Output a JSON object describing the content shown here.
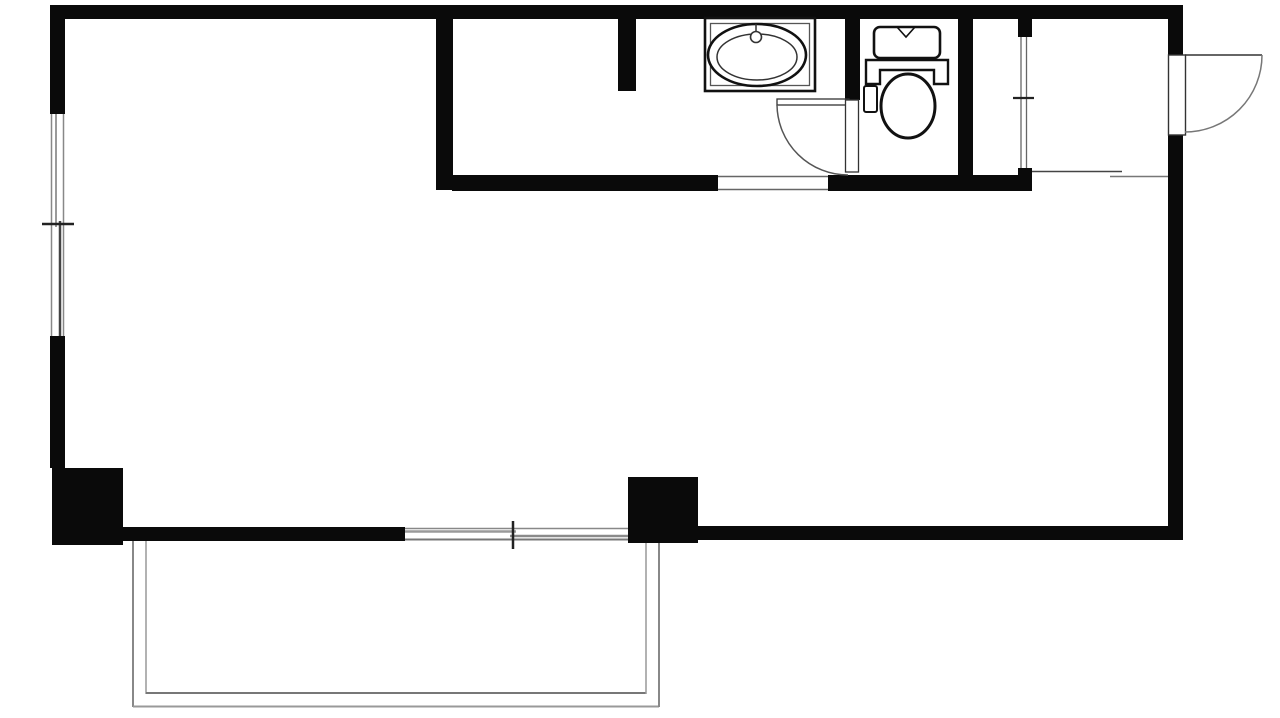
{
  "meta": {
    "title": "apartment-floor-plan",
    "canvas": {
      "width": 1280,
      "height": 718
    },
    "colors": {
      "wall": "#0a0a0a",
      "fixture_stroke": "#111111",
      "thin_dark": "#333333",
      "thin_mid": "#666666",
      "thin_light": "#999999",
      "background": "#ffffff"
    }
  },
  "plan": {
    "elements": [
      {
        "name": "top-wall",
        "kind": "rect",
        "x": 55,
        "y": 5,
        "w": 1128,
        "h": 14,
        "fill": "#0a0a0a"
      },
      {
        "name": "left-wall-upper",
        "kind": "rect",
        "x": 50,
        "y": 5,
        "w": 15,
        "h": 109,
        "fill": "#0a0a0a"
      },
      {
        "name": "left-wall-lower",
        "kind": "rect",
        "x": 50,
        "y": 336,
        "w": 15,
        "h": 132,
        "fill": "#0a0a0a"
      },
      {
        "name": "left-pillar",
        "kind": "rect",
        "x": 52,
        "y": 468,
        "w": 71,
        "h": 77,
        "fill": "#0a0a0a"
      },
      {
        "name": "bottom-wall-left",
        "kind": "rect",
        "x": 123,
        "y": 527,
        "w": 282,
        "h": 14,
        "fill": "#0a0a0a"
      },
      {
        "name": "right-pillar",
        "kind": "rect",
        "x": 628,
        "y": 477,
        "w": 70,
        "h": 66,
        "fill": "#0a0a0a"
      },
      {
        "name": "bottom-wall-right",
        "kind": "rect",
        "x": 698,
        "y": 526,
        "w": 485,
        "h": 14,
        "fill": "#0a0a0a"
      },
      {
        "name": "right-wall-upper",
        "kind": "rect",
        "x": 1168,
        "y": 5,
        "w": 15,
        "h": 50,
        "fill": "#0a0a0a"
      },
      {
        "name": "right-wall-lower",
        "kind": "rect",
        "x": 1168,
        "y": 135,
        "w": 15,
        "h": 405,
        "fill": "#0a0a0a"
      },
      {
        "name": "interior-wall-vertical",
        "kind": "rect",
        "x": 436,
        "y": 19,
        "w": 17,
        "h": 171,
        "fill": "#0a0a0a"
      },
      {
        "name": "interior-wall-horizontal-left",
        "kind": "rect",
        "x": 452,
        "y": 175,
        "w": 266,
        "h": 16,
        "fill": "#0a0a0a"
      },
      {
        "name": "interior-wall-horizontal-right",
        "kind": "rect",
        "x": 828,
        "y": 175,
        "w": 204,
        "h": 16,
        "fill": "#0a0a0a"
      },
      {
        "name": "kitchen-stub-wall",
        "kind": "rect",
        "x": 618,
        "y": 19,
        "w": 18,
        "h": 72,
        "fill": "#0a0a0a"
      },
      {
        "name": "toilet-left-wall",
        "kind": "rect",
        "x": 845,
        "y": 19,
        "w": 15,
        "h": 81,
        "fill": "#0a0a0a"
      },
      {
        "name": "toilet-right-wall",
        "kind": "rect",
        "x": 958,
        "y": 19,
        "w": 15,
        "h": 172,
        "fill": "#0a0a0a"
      },
      {
        "name": "closet-stub-top",
        "kind": "rect",
        "x": 1018,
        "y": 19,
        "w": 14,
        "h": 18,
        "fill": "#0a0a0a"
      },
      {
        "name": "closet-stub-bottom",
        "kind": "rect",
        "x": 1018,
        "y": 168,
        "w": 14,
        "h": 23,
        "fill": "#0a0a0a"
      },
      {
        "name": "left-window-bg",
        "kind": "rect",
        "x": 50,
        "y": 114,
        "w": 15,
        "h": 222,
        "fill": "#ffffff"
      },
      {
        "name": "left-window-edge-outer",
        "kind": "line",
        "x1": 51.5,
        "y1": 114,
        "x2": 51.5,
        "y2": 336,
        "stroke": "#888888",
        "sw": 1.5
      },
      {
        "name": "left-window-edge-inner",
        "kind": "line",
        "x1": 63.5,
        "y1": 114,
        "x2": 63.5,
        "y2": 336,
        "stroke": "#888888",
        "sw": 1.5
      },
      {
        "name": "left-window-sash-upper",
        "kind": "line",
        "x1": 56,
        "y1": 114,
        "x2": 56,
        "y2": 227,
        "stroke": "#9a9a9a",
        "sw": 2
      },
      {
        "name": "left-window-sash-lower",
        "kind": "line",
        "x1": 60,
        "y1": 221,
        "x2": 60,
        "y2": 336,
        "stroke": "#444444",
        "sw": 2.5
      },
      {
        "name": "left-window-tick",
        "kind": "line",
        "x1": 42,
        "y1": 224,
        "x2": 74,
        "y2": 224,
        "stroke": "#222222",
        "sw": 2.5
      },
      {
        "name": "bottom-window-bg",
        "kind": "rect",
        "x": 405,
        "y": 527,
        "w": 223,
        "h": 14,
        "fill": "#ffffff"
      },
      {
        "name": "bottom-window-edge-top",
        "kind": "line",
        "x1": 405,
        "y1": 528.5,
        "x2": 628,
        "y2": 528.5,
        "stroke": "#888888",
        "sw": 1.5
      },
      {
        "name": "bottom-window-edge-bottom",
        "kind": "line",
        "x1": 405,
        "y1": 539.5,
        "x2": 628,
        "y2": 539.5,
        "stroke": "#777777",
        "sw": 2
      },
      {
        "name": "bottom-window-sash-left",
        "kind": "line",
        "x1": 405,
        "y1": 531.5,
        "x2": 516,
        "y2": 531.5,
        "stroke": "#9a9a9a",
        "sw": 2.5
      },
      {
        "name": "bottom-window-sash-right",
        "kind": "line",
        "x1": 510,
        "y1": 536,
        "x2": 628,
        "y2": 536,
        "stroke": "#8a8a8a",
        "sw": 2.5
      },
      {
        "name": "bottom-window-tick",
        "kind": "line",
        "x1": 513,
        "y1": 521,
        "x2": 513,
        "y2": 549,
        "stroke": "#222222",
        "sw": 2.5
      },
      {
        "name": "main-room-opening-bg",
        "kind": "rect",
        "x": 718,
        "y": 175,
        "w": 110,
        "h": 16,
        "fill": "#ffffff"
      },
      {
        "name": "main-room-opening-line-top",
        "kind": "line",
        "x1": 718,
        "y1": 176.5,
        "x2": 828,
        "y2": 176.5,
        "stroke": "#666666",
        "sw": 1.5
      },
      {
        "name": "main-room-opening-line-bottom",
        "kind": "line",
        "x1": 718,
        "y1": 189.5,
        "x2": 828,
        "y2": 189.5,
        "stroke": "#666666",
        "sw": 1.5
      },
      {
        "name": "toilet-door-open-leaf",
        "kind": "rect",
        "x": 777,
        "y": 99,
        "w": 72,
        "h": 6,
        "fill": "#ffffff",
        "stroke": "#333333",
        "sw": 1.3
      },
      {
        "name": "toilet-door-arc",
        "kind": "path",
        "d": "M 777 105 A 71 71 0 0 0 848 175",
        "fill": "none",
        "stroke": "#555555",
        "sw": 1.5
      },
      {
        "name": "toilet-door-frame-leaf",
        "kind": "rect",
        "x": 845.5,
        "y": 100,
        "w": 13,
        "h": 72,
        "fill": "#ffffff",
        "stroke": "#333333",
        "sw": 1.3
      },
      {
        "name": "closet-slide-door-line-left",
        "kind": "line",
        "x1": 1021,
        "y1": 37,
        "x2": 1021,
        "y2": 168,
        "stroke": "#666666",
        "sw": 1.3
      },
      {
        "name": "closet-slide-door-line-right",
        "kind": "line",
        "x1": 1026.5,
        "y1": 37,
        "x2": 1026.5,
        "y2": 168,
        "stroke": "#666666",
        "sw": 1.3
      },
      {
        "name": "closet-slide-door-tick",
        "kind": "line",
        "x1": 1013,
        "y1": 98,
        "x2": 1034,
        "y2": 98,
        "stroke": "#222222",
        "sw": 2.2
      },
      {
        "name": "entry-floor-line",
        "kind": "line",
        "x1": 1032,
        "y1": 171.5,
        "x2": 1122,
        "y2": 171.5,
        "stroke": "#444444",
        "sw": 1.6
      },
      {
        "name": "entry-step-line",
        "kind": "line",
        "x1": 1110,
        "y1": 176.5,
        "x2": 1168,
        "y2": 176.5,
        "stroke": "#777777",
        "sw": 1.6
      },
      {
        "name": "entrance-door-leaf",
        "kind": "rect",
        "x": 1168.5,
        "y": 55,
        "w": 17,
        "h": 80,
        "fill": "#ffffff",
        "stroke": "#333333",
        "sw": 1.4
      },
      {
        "name": "entrance-door-open-line",
        "kind": "line",
        "x1": 1185,
        "y1": 55,
        "x2": 1262,
        "y2": 55,
        "stroke": "#333333",
        "sw": 1.6
      },
      {
        "name": "entrance-door-arc",
        "kind": "path",
        "d": "M 1262 55 A 77 77 0 0 1 1185 132",
        "fill": "none",
        "stroke": "#777777",
        "sw": 1.5
      },
      {
        "name": "sink-counter-outer",
        "kind": "rect",
        "x": 705,
        "y": 18,
        "w": 110,
        "h": 73,
        "fill": "#ffffff",
        "stroke": "#111111",
        "sw": 2.6
      },
      {
        "name": "sink-counter-inner",
        "kind": "rect",
        "x": 710.5,
        "y": 23.5,
        "w": 99,
        "h": 62,
        "fill": "none",
        "stroke": "#555555",
        "sw": 1.3
      },
      {
        "name": "sink-basin-outer",
        "kind": "ellipse",
        "cx": 757,
        "cy": 55,
        "rx": 49,
        "ry": 31,
        "fill": "#ffffff",
        "stroke": "#111111",
        "sw": 2.6
      },
      {
        "name": "sink-basin-inner",
        "kind": "ellipse",
        "cx": 757,
        "cy": 57,
        "rx": 40,
        "ry": 23,
        "fill": "none",
        "stroke": "#333333",
        "sw": 1.5
      },
      {
        "name": "sink-faucet-stem",
        "kind": "line",
        "x1": 756,
        "y1": 24,
        "x2": 756,
        "y2": 34,
        "stroke": "#333333",
        "sw": 1.5
      },
      {
        "name": "sink-faucet",
        "kind": "circle",
        "cx": 756,
        "cy": 37,
        "r": 5.5,
        "fill": "#ffffff",
        "stroke": "#333333",
        "sw": 1.6
      },
      {
        "name": "toilet-bowl",
        "kind": "ellipse",
        "cx": 908,
        "cy": 106,
        "rx": 27,
        "ry": 32,
        "fill": "#ffffff",
        "stroke": "#111111",
        "sw": 3
      },
      {
        "name": "toilet-seat-hinge",
        "kind": "path",
        "d": "M 866 60 H 948 V 84 H 934 V 70 H 880 V 84 H 866 Z",
        "fill": "#ffffff",
        "stroke": "#111111",
        "sw": 2.4
      },
      {
        "name": "toilet-tank",
        "kind": "rect",
        "x": 874,
        "y": 27,
        "w": 66,
        "h": 31,
        "rx": 6,
        "fill": "#ffffff",
        "stroke": "#111111",
        "sw": 2.6
      },
      {
        "name": "toilet-tank-notch",
        "kind": "path",
        "d": "M 897 27 L 906 37 L 915 27",
        "fill": "none",
        "stroke": "#111111",
        "sw": 1.6
      },
      {
        "name": "toilet-control-panel",
        "kind": "rect",
        "x": 864,
        "y": 86,
        "w": 13,
        "h": 26,
        "rx": 2,
        "fill": "#ffffff",
        "stroke": "#111111",
        "sw": 2
      },
      {
        "name": "balcony-rail-left-outer",
        "kind": "line",
        "x1": 133,
        "y1": 541,
        "x2": 133,
        "y2": 707,
        "stroke": "#888888",
        "sw": 2
      },
      {
        "name": "balcony-rail-left-inner",
        "kind": "line",
        "x1": 146,
        "y1": 541,
        "x2": 146,
        "y2": 694,
        "stroke": "#999999",
        "sw": 1.5
      },
      {
        "name": "balcony-rail-bottom-inner",
        "kind": "line",
        "x1": 146,
        "y1": 693,
        "x2": 646,
        "y2": 693,
        "stroke": "#777777",
        "sw": 2
      },
      {
        "name": "balcony-rail-bottom-outer",
        "kind": "line",
        "x1": 133,
        "y1": 706.5,
        "x2": 659,
        "y2": 706.5,
        "stroke": "#999999",
        "sw": 2
      },
      {
        "name": "balcony-rail-right-inner",
        "kind": "line",
        "x1": 646,
        "y1": 543,
        "x2": 646,
        "y2": 694,
        "stroke": "#999999",
        "sw": 1.5
      },
      {
        "name": "balcony-rail-right-outer",
        "kind": "line",
        "x1": 659,
        "y1": 543,
        "x2": 659,
        "y2": 707,
        "stroke": "#888888",
        "sw": 2
      }
    ]
  }
}
